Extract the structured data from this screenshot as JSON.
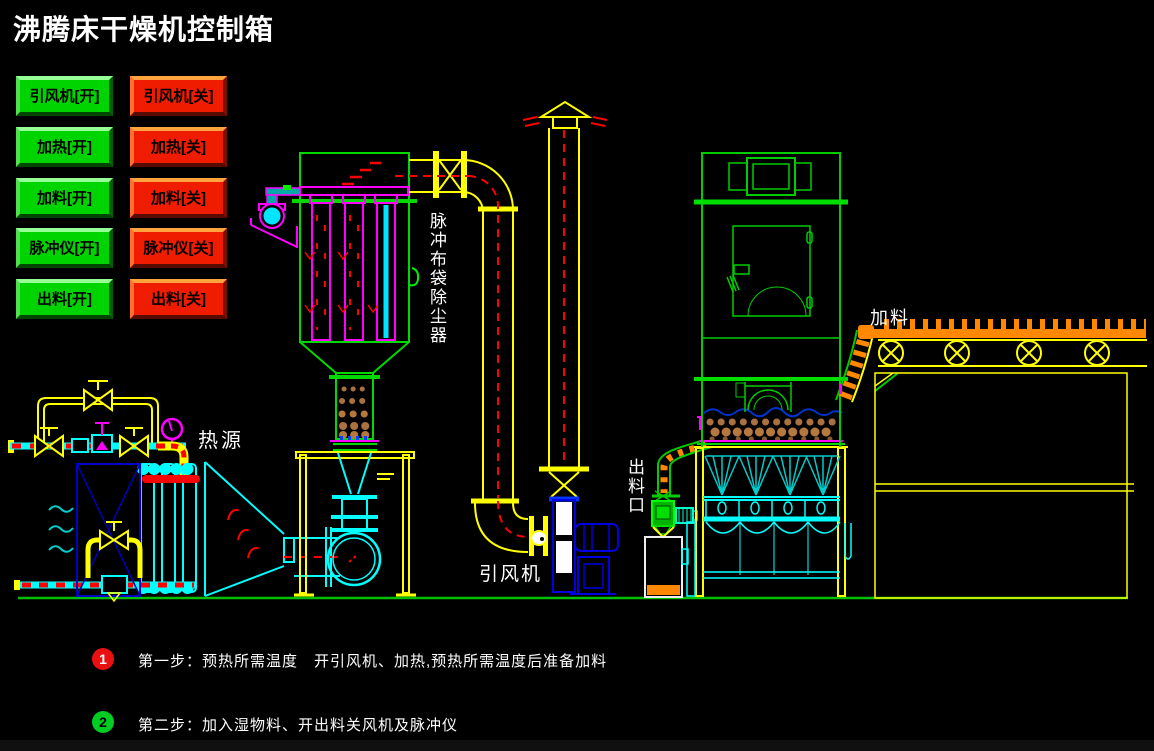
{
  "title": "沸腾床干燥机控制箱",
  "controls": {
    "on": [
      "引风机[开]",
      "加热[开]",
      "加料[开]",
      "脉冲仪[开]",
      "出料[开]"
    ],
    "off": [
      "引风机[关]",
      "加热[关]",
      "加料[关]",
      "脉冲仪[关]",
      "出料[关]"
    ]
  },
  "diagram_labels": {
    "dust_collector": "脉冲布袋除尘器",
    "heat_source": "热源",
    "induced_fan": "引风机",
    "discharge_port": "出料口",
    "feed": "加料"
  },
  "steps": [
    {
      "number": "1",
      "text": "第一步：预热所需温度　开引风机、加热,预热所需温度后准备加料"
    },
    {
      "number": "2",
      "text": "第二步：加入湿物料、开出料关风机及脉冲仪"
    }
  ],
  "colors": {
    "button_on": "#00d400",
    "button_off": "#f01c00",
    "cad_green": "#00d800",
    "cad_cyan": "#00ffff",
    "cad_yellow": "#ffff00",
    "cad_magenta": "#ff00ff",
    "cad_red": "#ff0000",
    "cad_blue": "#0000e0",
    "cad_orange": "#ff8800",
    "step1_badge": "#e81010",
    "step2_badge": "#00cc22"
  }
}
